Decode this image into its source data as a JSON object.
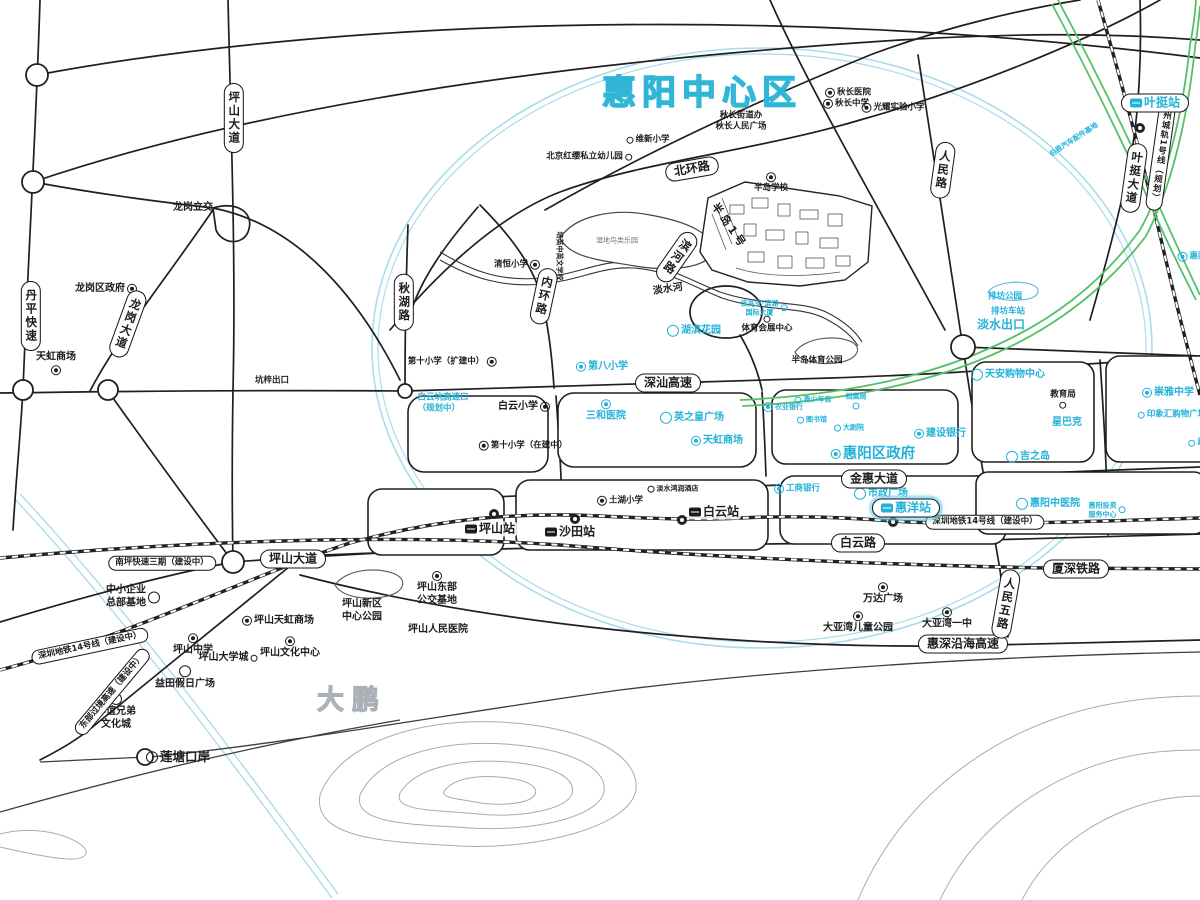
{
  "title": {
    "text": "惠阳中心区"
  },
  "colors": {
    "accent_cyan": "#23b2d8",
    "road_black": "#1f1f1f",
    "ring_teal": "#a8dee9",
    "planned_rail_green": "#55c167",
    "contour_gray": "#a7acb1"
  },
  "labels": [
    {
      "id": "pill-pingshan-ave-north",
      "text": "坪山大道",
      "x": 234,
      "y": 118,
      "cls": "pill vert"
    },
    {
      "id": "pill-danping-expressway",
      "text": "丹平快速",
      "x": 31,
      "y": 316,
      "cls": "pill vert"
    },
    {
      "id": "pill-longgang-avenue",
      "text": "龙岗大道",
      "x": 128,
      "y": 324,
      "cls": "pill vert",
      "rot": 20
    },
    {
      "id": "pill-beihuan-road",
      "text": "北环路",
      "x": 692,
      "y": 169,
      "cls": "pill md",
      "rot": -10
    },
    {
      "id": "pill-renmin-road",
      "text": "人民路",
      "x": 943,
      "y": 170,
      "cls": "pill vert",
      "rot": 8
    },
    {
      "id": "pill-qiuhu-road",
      "text": "秋湖路",
      "x": 404,
      "y": 302,
      "cls": "pill vert"
    },
    {
      "id": "pill-neihuan-road",
      "text": "内环路",
      "x": 544,
      "y": 296,
      "cls": "pill vert",
      "rot": 12
    },
    {
      "id": "pill-binhe-road",
      "text": "滨河路",
      "x": 677,
      "y": 257,
      "cls": "pill vert",
      "rot": 35
    },
    {
      "id": "pill-shenshan-expressway",
      "text": "深汕高速",
      "x": 668,
      "y": 383,
      "cls": "pill md"
    },
    {
      "id": "pill-jinhui-avenue",
      "text": "金惠大道",
      "x": 874,
      "y": 479,
      "cls": "pill md"
    },
    {
      "id": "pill-baiyun-road",
      "text": "白云路",
      "x": 858,
      "y": 543,
      "cls": "pill md"
    },
    {
      "id": "pill-metro14-east",
      "text": "深圳地铁14号线（建设中）",
      "x": 985,
      "y": 522,
      "cls": "pill xs"
    },
    {
      "id": "pill-metro14-west",
      "text": "深圳地铁14号线（建设中）",
      "x": 90,
      "y": 646,
      "cls": "pill xs",
      "rot": -12
    },
    {
      "id": "pill-nanping-expressway-3",
      "text": "南坪快速三期（建设中）",
      "x": 162,
      "y": 563,
      "cls": "pill xs"
    },
    {
      "id": "pill-pingshan-ave-south",
      "text": "坪山大道",
      "x": 293,
      "y": 559,
      "cls": "pill md"
    },
    {
      "id": "pill-xiashen-railway",
      "text": "厦深铁路",
      "x": 1076,
      "y": 569,
      "cls": "pill md"
    },
    {
      "id": "pill-huishen-coastal-expressway",
      "text": "惠深沿海高速",
      "x": 963,
      "y": 644,
      "cls": "pill md"
    },
    {
      "id": "pill-renmin-5th-road",
      "text": "人民五路",
      "x": 1006,
      "y": 604,
      "cls": "pill vert",
      "rot": 10
    },
    {
      "id": "pill-yeting-avenue",
      "text": "叶挺大道",
      "x": 1134,
      "y": 178,
      "cls": "pill vert",
      "rot": 8
    },
    {
      "id": "pill-huizhou-rail-line1",
      "text": "惠州城轨1号线（规划）",
      "x": 1161,
      "y": 152,
      "cls": "pill vert xs",
      "rot": 8
    },
    {
      "id": "pill-eastern-corridor-expressway",
      "text": "东部过境高速（建设中）",
      "x": 112,
      "y": 692,
      "cls": "pill xs",
      "rot": -50
    },
    {
      "id": "yeting-station",
      "text": "叶挺站",
      "x": 1155,
      "y": 103,
      "cls": "pill md cyan",
      "icon": "train-icon",
      "iconpos": "left"
    },
    {
      "id": "huiyang-station",
      "text": "惠洋站",
      "x": 906,
      "y": 508,
      "cls": "pill md cyan glow",
      "icon": "train-icon",
      "iconpos": "left"
    },
    {
      "id": "pingshan-station",
      "text": "坪山站",
      "x": 490,
      "y": 529,
      "cls": "station",
      "icon": "train-icon",
      "iconpos": "left"
    },
    {
      "id": "shatian-station",
      "text": "沙田站",
      "x": 570,
      "y": 532,
      "cls": "station",
      "icon": "train-icon",
      "iconpos": "left"
    },
    {
      "id": "baiyun-station",
      "text": "白云站",
      "x": 714,
      "y": 512,
      "cls": "station",
      "icon": "train-icon",
      "iconpos": "left"
    },
    {
      "id": "dapeng-area",
      "text": "大鹏",
      "x": 352,
      "y": 701,
      "cls": "area-gray"
    },
    {
      "id": "qiuchang-hospital",
      "text": "秋长医院",
      "x": 848,
      "y": 93,
      "cls": "xs",
      "icon": "hospital-icon",
      "iconpos": "left"
    },
    {
      "id": "qiuchang-middle-school",
      "text": "秋长中学",
      "x": 846,
      "y": 104,
      "cls": "xs",
      "icon": "school-icon",
      "iconpos": "left"
    },
    {
      "id": "guangyao-experimental-primary",
      "text": "光耀实验小学",
      "x": 893,
      "y": 108,
      "cls": "xs",
      "icon": "school-icon",
      "iconpos": "left"
    },
    {
      "id": "qiuchang-subdistrict-office",
      "text": "秋长街道办\n秋长人民广场",
      "x": 741,
      "y": 121,
      "cls": "xs"
    },
    {
      "id": "weixin-primary-school",
      "text": "维新小学",
      "x": 648,
      "y": 140,
      "cls": "xs",
      "icon": "dot-icon",
      "iconpos": "left"
    },
    {
      "id": "beijing-hongying-kindergarten",
      "text": "北京红缨私立幼儿园",
      "x": 589,
      "y": 157,
      "cls": "xs",
      "icon": "dot-icon",
      "iconpos": "right"
    },
    {
      "id": "bandao-school",
      "text": "半岛学校",
      "x": 771,
      "y": 183,
      "cls": "xs col",
      "icon": "school-icon",
      "iconpos": "above"
    },
    {
      "id": "qingheng-primary-school",
      "text": "清恒小学",
      "x": 517,
      "y": 265,
      "cls": "xs",
      "icon": "school-icon",
      "iconpos": "right"
    },
    {
      "id": "wetland-bird-park",
      "text": "湿地鸟类乐园",
      "x": 617,
      "y": 241,
      "cls": "xxs gray2"
    },
    {
      "id": "peiying-bilingual-school",
      "text": "培英中英文学校",
      "x": 559,
      "y": 256,
      "cls": "xxs",
      "rot": 90
    },
    {
      "id": "bandao-no1-estate",
      "text": "半岛1号",
      "x": 729,
      "y": 226,
      "cls": "spaced",
      "rot": 55
    },
    {
      "id": "danshui-river-label",
      "text": "淡水河",
      "x": 668,
      "y": 290,
      "cls": "sm",
      "rot": -8
    },
    {
      "id": "no10-primary-expansion",
      "text": "第十小学（扩建中）",
      "x": 452,
      "y": 362,
      "cls": "xs",
      "icon": "school-icon",
      "iconpos": "right"
    },
    {
      "id": "baiyun-primary-school",
      "text": "白云小学",
      "x": 524,
      "y": 407,
      "cls": "sm",
      "icon": "school-icon",
      "iconpos": "right"
    },
    {
      "id": "no10-primary-construction",
      "text": "第十小学（在建中）",
      "x": 523,
      "y": 446,
      "cls": "xs",
      "icon": "school-icon",
      "iconpos": "left"
    },
    {
      "id": "longgang-interchange",
      "text": "龙岗立交",
      "x": 193,
      "y": 208,
      "cls": "sm"
    },
    {
      "id": "longgang-district-gov",
      "text": "龙岗区政府",
      "x": 106,
      "y": 289,
      "cls": "sm",
      "icon": "gov-icon",
      "iconpos": "right"
    },
    {
      "id": "tianhong-mall-longgang",
      "text": "天虹商场",
      "x": 56,
      "y": 363,
      "cls": "sm col",
      "icon": "shop-icon",
      "iconpos": "below"
    },
    {
      "id": "kengzi-exit",
      "text": "坑梓出口",
      "x": 272,
      "y": 381,
      "cls": "xs"
    },
    {
      "id": "sports-expo-center",
      "text": "体育会展中心",
      "x": 767,
      "y": 325,
      "cls": "xs col",
      "icon": "dot-icon",
      "iconpos": "above"
    },
    {
      "id": "bandao-sports-park",
      "text": "半岛体育公园",
      "x": 817,
      "y": 361,
      "cls": "xs"
    },
    {
      "id": "tuhu-primary-school",
      "text": "土湖小学",
      "x": 620,
      "y": 501,
      "cls": "xs",
      "icon": "school-icon",
      "iconpos": "left"
    },
    {
      "id": "danshui-hotel",
      "text": "淡水鸿润酒店",
      "x": 673,
      "y": 489,
      "cls": "xxs",
      "icon": "dot-icon",
      "iconpos": "left"
    },
    {
      "id": "education-bureau",
      "text": "教育局",
      "x": 1063,
      "y": 399,
      "cls": "xs col",
      "icon": "dot-icon",
      "iconpos": "below"
    },
    {
      "id": "sme-headquarters-base",
      "text": "中小企业\n总部基地",
      "x": 133,
      "y": 597,
      "cls": "sm",
      "icon": "poi-circle-icon",
      "iconpos": "right"
    },
    {
      "id": "pingshan-east-bus-base",
      "text": "坪山东部\n公交基地",
      "x": 437,
      "y": 589,
      "cls": "sm col",
      "icon": "bus-icon",
      "iconpos": "above"
    },
    {
      "id": "pingshan-new-district-central-park",
      "text": "坪山新区\n中心公园",
      "x": 362,
      "y": 611,
      "cls": "sm"
    },
    {
      "id": "pingshan-peoples-hospital",
      "text": "坪山人民医院",
      "x": 438,
      "y": 630,
      "cls": "sm"
    },
    {
      "id": "pingshan-tianhong-mall",
      "text": "坪山天虹商场",
      "x": 278,
      "y": 621,
      "cls": "sm",
      "icon": "shop-icon",
      "iconpos": "left"
    },
    {
      "id": "pingshan-middle-school",
      "text": "坪山中学",
      "x": 193,
      "y": 645,
      "cls": "sm col",
      "icon": "school-icon",
      "iconpos": "above"
    },
    {
      "id": "pingshan-university-town",
      "text": "坪山大学城",
      "x": 228,
      "y": 658,
      "cls": "sm",
      "icon": "dot-icon",
      "iconpos": "right"
    },
    {
      "id": "pingshan-culture-center",
      "text": "坪山文化中心",
      "x": 290,
      "y": 648,
      "cls": "sm col",
      "icon": "gov-icon",
      "iconpos": "above"
    },
    {
      "id": "yitian-holiday-plaza",
      "text": "益田假日广场",
      "x": 185,
      "y": 678,
      "cls": "sm col",
      "icon": "poi-circle-icon",
      "iconpos": "above"
    },
    {
      "id": "huayi-brothers-culture-city",
      "text": "华谊兄弟\n文化城",
      "x": 116,
      "y": 712,
      "cls": "sm col",
      "icon": "poi-circle-icon",
      "iconpos": "above"
    },
    {
      "id": "liantang-port",
      "text": "莲塘口岸",
      "x": 178,
      "y": 757,
      "cls": "md-black",
      "icon": "poi-circle-icon",
      "iconpos": "left"
    },
    {
      "id": "wanda-plaza",
      "text": "万达广场",
      "x": 883,
      "y": 594,
      "cls": "sm col",
      "icon": "shop-icon",
      "iconpos": "above"
    },
    {
      "id": "dayabay-children-park",
      "text": "大亚湾儿童公园",
      "x": 858,
      "y": 623,
      "cls": "sm col",
      "icon": "gov-icon",
      "iconpos": "above"
    },
    {
      "id": "dayabay-no1-middle-school",
      "text": "大亚湾一中",
      "x": 947,
      "y": 619,
      "cls": "sm col",
      "icon": "school-icon",
      "iconpos": "above"
    },
    {
      "id": "baiyunkeng-expressway-exit",
      "text": "白云坑高速口\n（规划中）",
      "x": 443,
      "y": 403,
      "cls": "cyan xs left-align"
    },
    {
      "id": "no8-primary-school",
      "text": "第八小学",
      "x": 602,
      "y": 367,
      "cls": "cyan sm",
      "icon": "school-icon",
      "iconpos": "left"
    },
    {
      "id": "sanhe-hospital",
      "text": "三和医院",
      "x": 606,
      "y": 411,
      "cls": "cyan sm col",
      "icon": "hospital-icon",
      "iconpos": "above"
    },
    {
      "id": "yingzhihuang-plaza",
      "text": "英之皇广场",
      "x": 692,
      "y": 418,
      "cls": "cyan sm",
      "icon": "poi-circle-icon",
      "iconpos": "left"
    },
    {
      "id": "tianhong-mall-danshui",
      "text": "天虹商场",
      "x": 717,
      "y": 441,
      "cls": "cyan sm",
      "icon": "shop-icon",
      "iconpos": "left"
    },
    {
      "id": "hubin-garden",
      "text": "湖滨花园",
      "x": 694,
      "y": 331,
      "cls": "cyan sm",
      "icon": "poi-circle-icon",
      "iconpos": "left"
    },
    {
      "id": "jiazhaoye-tower",
      "text": "佳兆业·滨湖\n国际大厦",
      "x": 764,
      "y": 308,
      "cls": "cyan xxs",
      "icon": "dot-icon",
      "iconpos": "right"
    },
    {
      "id": "huiyang-district-gov",
      "text": "惠阳区政府",
      "x": 873,
      "y": 454,
      "cls": "cyan lg",
      "icon": "gov-icon",
      "iconpos": "left"
    },
    {
      "id": "youth-palace",
      "text": "青少年宫",
      "x": 813,
      "y": 400,
      "cls": "cyan xxs",
      "icon": "dot-icon",
      "iconpos": "left"
    },
    {
      "id": "agricultural-bank",
      "text": "农业银行",
      "x": 783,
      "y": 407,
      "cls": "cyan xxs",
      "icon": "bank-icon",
      "iconpos": "left"
    },
    {
      "id": "library",
      "text": "图书馆",
      "x": 812,
      "y": 420,
      "cls": "cyan xxs",
      "icon": "dot-icon",
      "iconpos": "left"
    },
    {
      "id": "grand-theater",
      "text": "大剧院",
      "x": 849,
      "y": 428,
      "cls": "cyan xxs",
      "icon": "dot-icon",
      "iconpos": "left"
    },
    {
      "id": "archives-bureau",
      "text": "档案局",
      "x": 856,
      "y": 401,
      "cls": "cyan xxs col",
      "icon": "dot-icon",
      "iconpos": "below"
    },
    {
      "id": "construction-bank",
      "text": "建设银行",
      "x": 940,
      "y": 434,
      "cls": "cyan sm",
      "icon": "bank-icon",
      "iconpos": "left"
    },
    {
      "id": "civic-square",
      "text": "市政广场",
      "x": 881,
      "y": 494,
      "cls": "cyan sm",
      "icon": "poi-circle-icon",
      "iconpos": "left"
    },
    {
      "id": "icbc-bank",
      "text": "工商银行",
      "x": 797,
      "y": 489,
      "cls": "cyan xs",
      "icon": "bank-icon",
      "iconpos": "left"
    },
    {
      "id": "huiyang-tcm-hospital",
      "text": "惠阳中医院",
      "x": 1048,
      "y": 504,
      "cls": "cyan sm",
      "icon": "poi-circle-icon",
      "iconpos": "left"
    },
    {
      "id": "huiyang-investment-service-center",
      "text": "惠阳投资\n服务中心",
      "x": 1107,
      "y": 510,
      "cls": "cyan xxs",
      "icon": "dot-icon",
      "iconpos": "right"
    },
    {
      "id": "tianan-shopping-center",
      "text": "天安购物中心",
      "x": 1008,
      "y": 375,
      "cls": "cyan sm",
      "icon": "poi-circle-icon",
      "iconpos": "left"
    },
    {
      "id": "starbucks",
      "text": "星巴克",
      "x": 1067,
      "y": 423,
      "cls": "cyan sm"
    },
    {
      "id": "jusco",
      "text": "吉之岛",
      "x": 1028,
      "y": 457,
      "cls": "cyan sm",
      "icon": "poi-circle-icon",
      "iconpos": "left"
    },
    {
      "id": "chongya-middle-school",
      "text": "崇雅中学",
      "x": 1168,
      "y": 393,
      "cls": "cyan sm",
      "icon": "school-icon",
      "iconpos": "left"
    },
    {
      "id": "yinxianghui-shopping-plaza",
      "text": "印象汇购物广场",
      "x": 1172,
      "y": 415,
      "cls": "cyan xs",
      "icon": "dot-icon",
      "iconpos": "left"
    },
    {
      "id": "paifang-park",
      "text": "排坊公园",
      "x": 1005,
      "y": 297,
      "cls": "cyan xs"
    },
    {
      "id": "paifang-bus-station",
      "text": "排坊车站",
      "x": 1008,
      "y": 312,
      "cls": "cyan xs"
    },
    {
      "id": "danshui-exit",
      "text": "淡水出口",
      "x": 1001,
      "y": 325,
      "cls": "cyan md2"
    },
    {
      "id": "boen-auto-parts-base",
      "text": "伯恩汽车配件基地",
      "x": 1074,
      "y": 140,
      "cls": "cyan xxs",
      "rot": -33
    },
    {
      "id": "huiyang-partial-label-ne",
      "text": "惠阳",
      "x": 1192,
      "y": 257,
      "cls": "cyan xs",
      "icon": "school-icon",
      "iconpos": "left"
    },
    {
      "id": "huiyang-partial-label-e",
      "text": "惠",
      "x": 1197,
      "y": 443,
      "cls": "cyan xs",
      "icon": "dot-icon",
      "iconpos": "left"
    }
  ]
}
